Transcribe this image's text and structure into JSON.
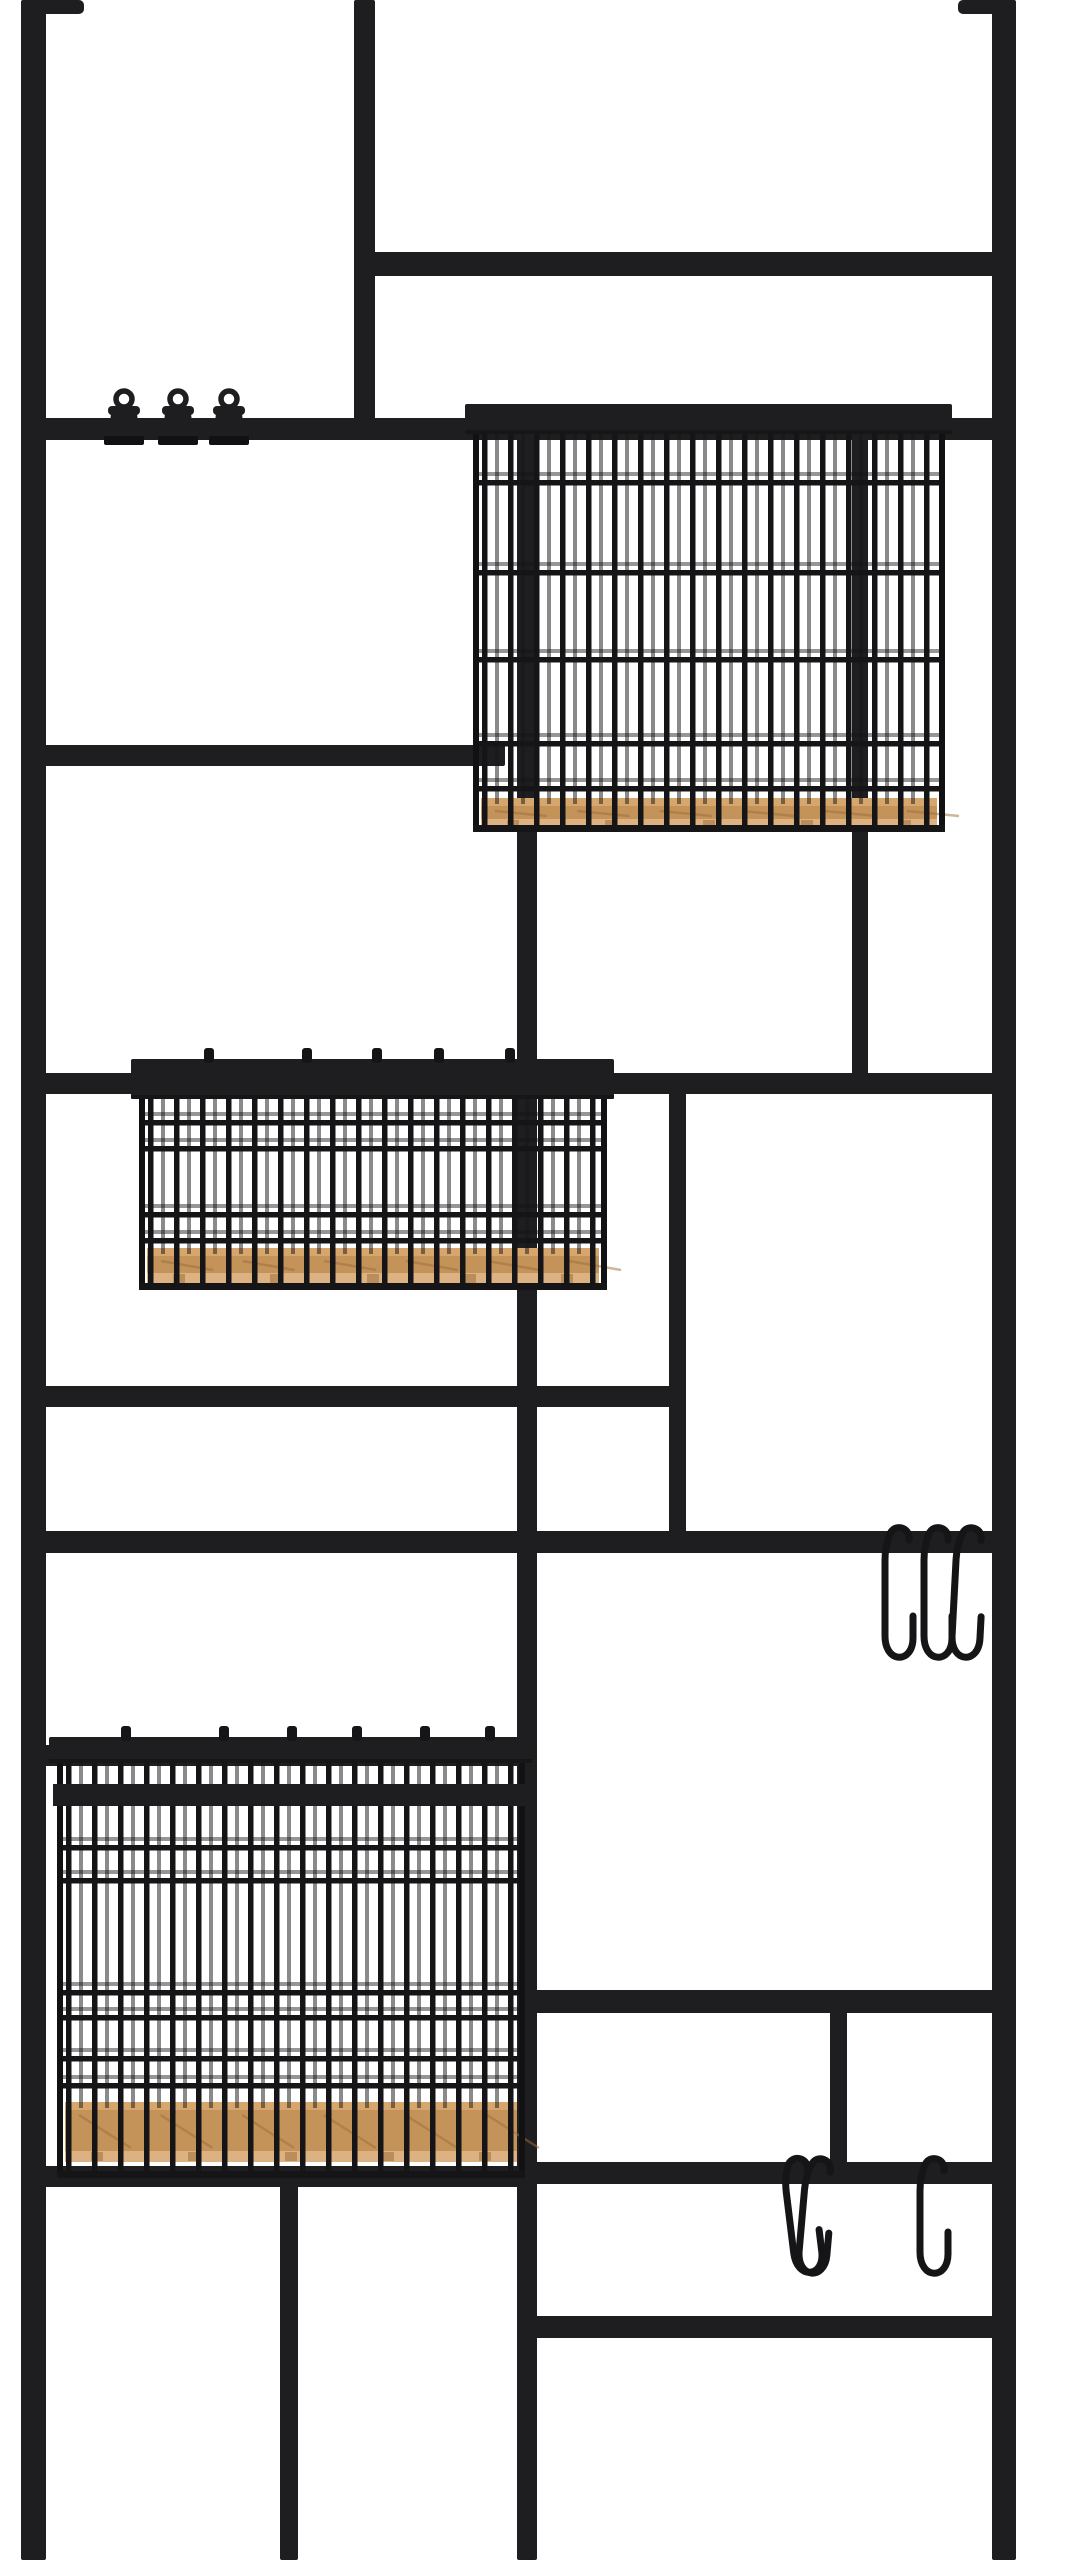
{
  "scene": {
    "alt": "Black metal wall-mounted grid organizer with three wire baskets on wood bases, three binder clips and S-hooks, photographed on a white background",
    "canvas": {
      "width": 1076,
      "height": 2560
    },
    "colors": {
      "background": "#ffffff",
      "metal": "#1e1e20",
      "metal_deep": "#111113",
      "wire": "#151517",
      "wood_top": "#d7a66c",
      "wood_front": "#c4935a",
      "wood_light": "#dcb282",
      "wood_grain": "#9e6f3c"
    }
  },
  "brackets": [
    {
      "x": 36,
      "y": 0,
      "w": 48,
      "h": 14
    },
    {
      "x": 958,
      "y": 0,
      "w": 52,
      "h": 14
    }
  ],
  "frame": {
    "verticals": [
      {
        "name": "left-rail",
        "x": 21,
        "w": 25,
        "y1": 0,
        "y2": 2560
      },
      {
        "name": "right-rail",
        "x": 992,
        "w": 24,
        "y1": 0,
        "y2": 2560
      },
      {
        "name": "top-divider",
        "x": 354,
        "w": 21,
        "y1": 0,
        "y2": 440
      },
      {
        "name": "center-rail",
        "x": 517,
        "w": 20,
        "y1": 404,
        "y2": 2560
      },
      {
        "name": "upper-right-divider",
        "x": 852,
        "w": 16,
        "y1": 430,
        "y2": 1094
      },
      {
        "name": "mid-divider",
        "x": 669,
        "w": 17,
        "y1": 1073,
        "y2": 1553
      },
      {
        "name": "lower-right-divider",
        "x": 830,
        "w": 17,
        "y1": 2005,
        "y2": 2168
      },
      {
        "name": "bottom-left-divider",
        "x": 280,
        "w": 18,
        "y1": 2170,
        "y2": 2560
      }
    ],
    "horizontals": [
      {
        "name": "bar-top-right",
        "y": 252,
        "h": 24,
        "x1": 354,
        "x2": 1016
      },
      {
        "name": "bar-clip-rail",
        "y": 418,
        "h": 22,
        "x1": 21,
        "x2": 1016
      },
      {
        "name": "bar-upper-left",
        "y": 745,
        "h": 21,
        "x1": 21,
        "x2": 505
      },
      {
        "name": "bar-middle",
        "y": 1073,
        "h": 21,
        "x1": 21,
        "x2": 1016
      },
      {
        "name": "bar-middle-left",
        "y": 1386,
        "h": 21,
        "x1": 21,
        "x2": 686
      },
      {
        "name": "bar-long",
        "y": 1531,
        "h": 22,
        "x1": 21,
        "x2": 1016
      },
      {
        "name": "bar-basket-hanger",
        "y": 1745,
        "h": 21,
        "x1": 21,
        "x2": 537
      },
      {
        "name": "bar-lower-right-top",
        "y": 1990,
        "h": 23,
        "x1": 517,
        "x2": 1016
      },
      {
        "name": "bar-lower-right-mid",
        "y": 2162,
        "h": 22,
        "x1": 517,
        "x2": 1016
      },
      {
        "name": "bar-bottom-left",
        "y": 2166,
        "h": 21,
        "x1": 21,
        "x2": 537
      },
      {
        "name": "bar-lower-right-low",
        "y": 2316,
        "h": 22,
        "x1": 517,
        "x2": 1016
      }
    ]
  },
  "clips": {
    "positions": [
      124,
      178,
      229
    ],
    "ring_cy": 399,
    "ring_r": 8
  },
  "baskets": [
    {
      "name": "basket-top",
      "x": 473,
      "y": 404,
      "w": 472,
      "h": 428,
      "band_h": 30,
      "wood_y": 798,
      "wood_h": 34,
      "v_spacing": 26,
      "h_wires": [
        480,
        570,
        657,
        741,
        786
      ],
      "tabs": []
    },
    {
      "name": "basket-middle",
      "x": 139,
      "y": 1059,
      "w": 468,
      "h": 231,
      "band_h": 40,
      "wood_y": 1248,
      "wood_h": 38,
      "v_spacing": 26,
      "h_wires": [
        1120,
        1146,
        1212,
        1238
      ],
      "tabs": [
        209,
        307,
        377,
        439,
        510
      ]
    },
    {
      "name": "basket-bottom",
      "x": 57,
      "y": 1737,
      "w": 468,
      "h": 441,
      "band_h": 26,
      "band2_y": 1784,
      "band2_h": 22,
      "wood_y": 2102,
      "wood_h": 62,
      "v_spacing": 26,
      "h_wires": [
        1845,
        1878,
        1990,
        2015,
        2056,
        2083
      ],
      "tabs": [
        126,
        224,
        292,
        357,
        425,
        490
      ]
    }
  ],
  "s_hooks": [
    {
      "rail": "bar-long",
      "rail_y": 1542,
      "len": 130,
      "hooks": [
        {
          "x": 897,
          "tilt": 0
        },
        {
          "x": 936,
          "tilt": 0
        },
        {
          "x": 969,
          "tilt": 3
        }
      ]
    },
    {
      "rail": "bar-lower-right-mid",
      "rail_y": 2173,
      "len": 115,
      "hooks": [
        {
          "x": 796,
          "tilt": -7
        },
        {
          "x": 818,
          "tilt": 5
        },
        {
          "x": 932,
          "tilt": 0
        }
      ]
    }
  ]
}
